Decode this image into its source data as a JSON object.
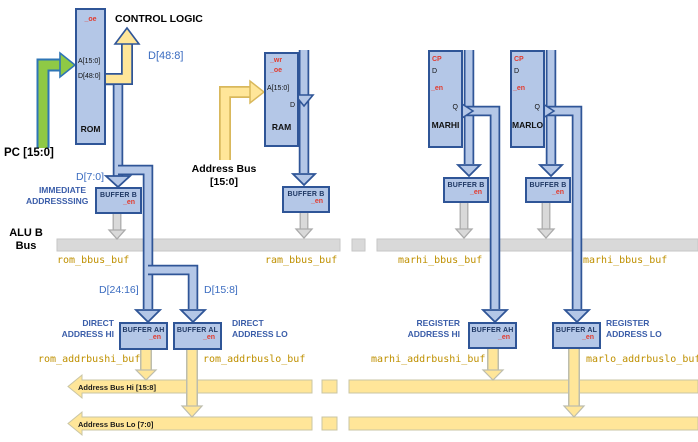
{
  "blocks": {
    "rom": {
      "name": "ROM",
      "pins": {
        "oe": "_oe",
        "a": "A[15:0]",
        "d": "D[48:0]"
      }
    },
    "ram": {
      "name": "RAM",
      "pins": {
        "wr": "_wr",
        "oe": "_oe",
        "a": "A[15:0]",
        "d": "D"
      }
    },
    "marhi": {
      "name": "MARHI",
      "pins": {
        "cp": "CP",
        "d": "D",
        "en": "_en",
        "q": "Q"
      }
    },
    "marlo": {
      "name": "MARLO",
      "pins": {
        "cp": "CP",
        "d": "D",
        "en": "_en",
        "q": "Q"
      }
    }
  },
  "buffers": {
    "rom_b": {
      "label": "BUFFER B",
      "en": "_en"
    },
    "ram_b": {
      "label": "BUFFER B",
      "en": "_en"
    },
    "marhi_b": {
      "label": "BUFFER B",
      "en": "_en"
    },
    "marlo_b": {
      "label": "BUFFER B",
      "en": "_en"
    },
    "rom_ah": {
      "label": "BUFFER AH",
      "en": "_en"
    },
    "rom_al": {
      "label": "BUFFER AL",
      "en": "_en"
    },
    "marhi_ah": {
      "label": "BUFFER AH",
      "en": "_en"
    },
    "marlo_al": {
      "label": "BUFFER AL",
      "en": "_en"
    }
  },
  "labels": {
    "control_logic": "CONTROL LOGIC",
    "pc": "PC [15:0]",
    "d48_8": "D[48:8]",
    "d7_0": "D[7:0]",
    "d24_16": "D[24:16]",
    "d15_8": "D[15:8]",
    "immediate": "IMMEDIATE ADDRESSSING",
    "alu_b_bus": "ALU B Bus",
    "address_bus": "Address Bus [15:0]",
    "direct_hi": "DIRECT ADDRESS HI",
    "direct_lo": "DIRECT ADDRESS LO",
    "register_hi": "REGISTER ADDRESS HI",
    "register_lo": "REGISTER ADDRESS LO"
  },
  "signals": {
    "rom_bbus_buf": "rom_bbus_buf",
    "ram_bbus_buf": "ram_bbus_buf",
    "marhi_bbus_buf_left": "marhi_bbus_buf",
    "marhi_bbus_buf_right": "marhi_bbus_buf",
    "rom_addrbushi_buf": "rom_addrbushi_buf",
    "rom_addrbuslo_buf": "rom_addrbuslo_buf",
    "marhi_addrbushi_buf": "marhi_addrbushi_buf",
    "marlo_addrbuslo_buf": "marlo_addrbuslo_buf"
  },
  "buses": {
    "hi": "Address Bus Hi [15:8]",
    "lo": "Address Bus Lo [7:0]"
  },
  "colors": {
    "block_fill": "#b4c7e7",
    "block_border": "#2f5597",
    "red_pin": "#e23b2e",
    "blue_label": "#3b6cc0",
    "blue_bold_label": "#3a5da9",
    "olive_label": "#bf9000",
    "bus_yellow": "#ffe699",
    "bus_gray": "#d9d9d9",
    "pc_green": "#8fc945"
  }
}
